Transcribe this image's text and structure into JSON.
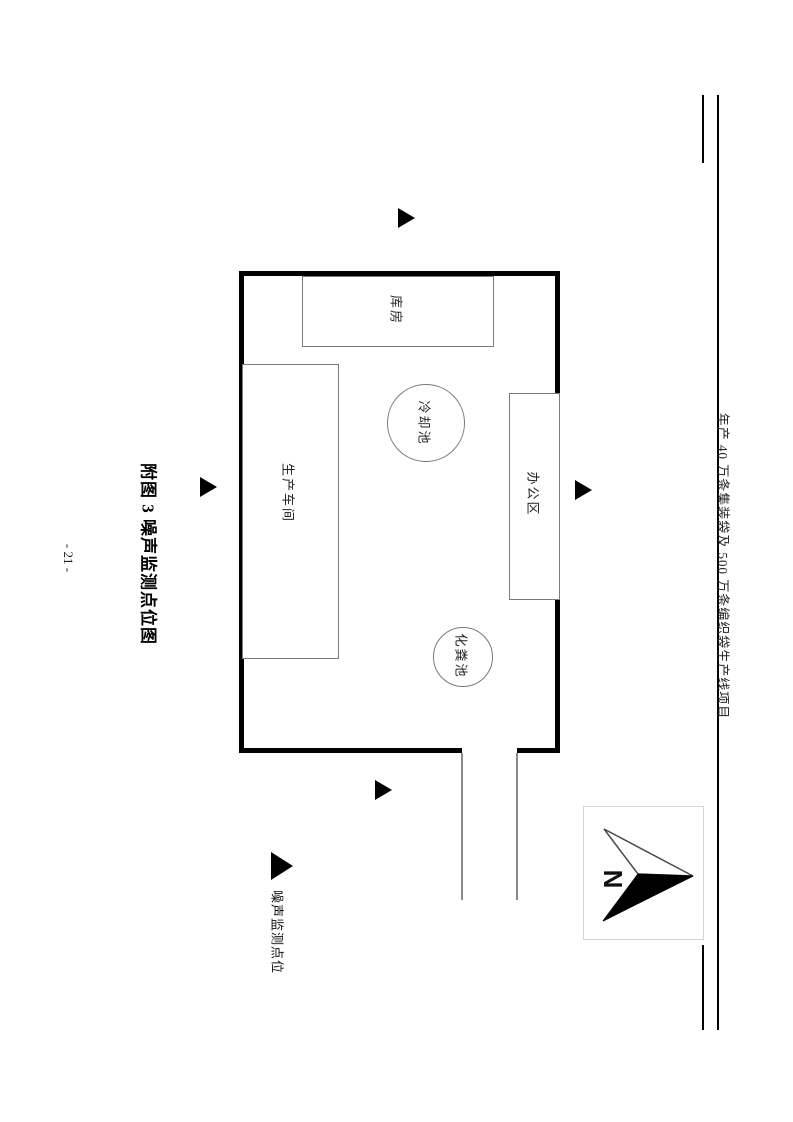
{
  "page": {
    "header_title": "年产 40 万条集装袋及 500 万条编织袋生产线项目",
    "figure_title": "附图 3 噪声监测点位图",
    "page_number": "- 21 -"
  },
  "diagram": {
    "site": {
      "warehouse_label": "库房",
      "workshop_label": "生产车间",
      "office_label": "办公区",
      "cooling_pool_label": "冷却池",
      "septic_tank_label": "化粪池"
    },
    "monitoring_points": {
      "count": 4,
      "sides": [
        "north",
        "west",
        "east",
        "south"
      ],
      "symbol": "black-right-triangle"
    },
    "legend": {
      "label": "噪声监测点位"
    },
    "compass": {
      "label": "N"
    },
    "colors": {
      "wall": "#000000",
      "thin_border": "#7a7a7a",
      "text": "#1a1a1a"
    }
  }
}
